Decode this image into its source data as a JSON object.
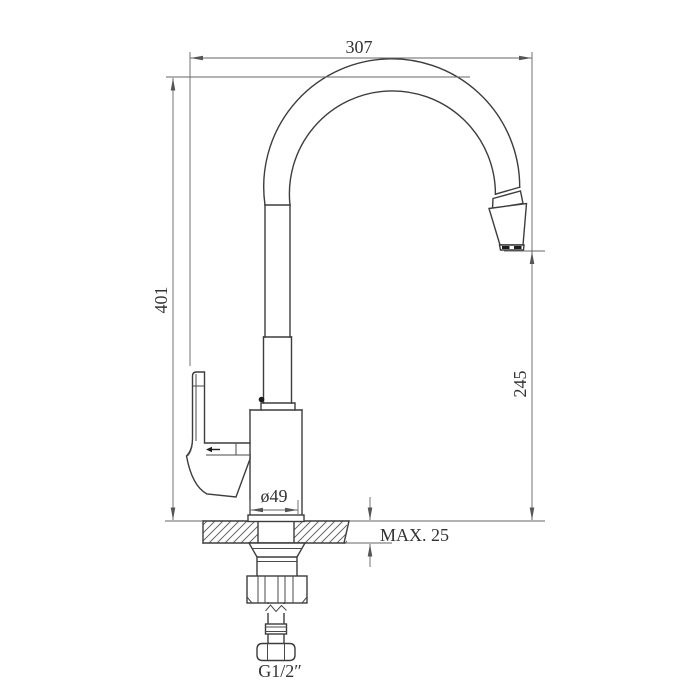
{
  "drawing": {
    "dimensions": {
      "spout_reach": "307",
      "overall_height": "401",
      "outlet_height": "245",
      "base_diameter": "ø49",
      "max_deck_thickness": "MAX. 25",
      "inlet_thread": "G1/2″"
    },
    "colors": {
      "background": "#ffffff",
      "object_line": "#3d3d3d",
      "dimension_line": "#646464",
      "text": "#333333"
    }
  }
}
